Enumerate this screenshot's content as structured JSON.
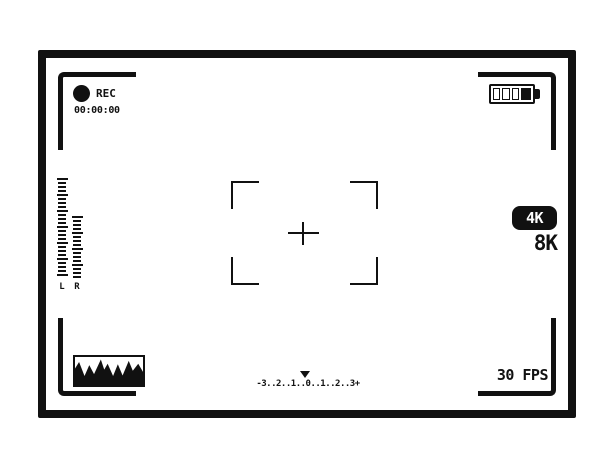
{
  "viewfinder": {
    "colors": {
      "ink": "#111111",
      "paper": "#ffffff"
    },
    "rec": {
      "label": "REC",
      "timecode": "00:00:00",
      "dot_icon": "filled-circle"
    },
    "battery": {
      "icon": "battery-horizontal",
      "cells": [
        "empty",
        "empty",
        "empty",
        "filled"
      ],
      "filled_side": "right"
    },
    "audio_meter": {
      "left_label": "L",
      "right_label": "R",
      "left_bars": 25,
      "right_bars": 16,
      "wide_every": 4
    },
    "focus": {
      "crosshair_icon": "plus-crosshair",
      "bracket_icon": "corner-bracket"
    },
    "resolution": {
      "active": "4K",
      "secondary": "8K"
    },
    "framerate": "30 FPS",
    "exposure_scale": {
      "text": "-3..2..1..0..1..2..3+",
      "marker_icon": "triangle-down",
      "marker_over": "0"
    },
    "histogram": {
      "icon": "waveform-mountains",
      "points": [
        [
          0,
          41
        ],
        [
          6,
          18
        ],
        [
          14,
          68
        ],
        [
          21,
          29
        ],
        [
          28,
          61
        ],
        [
          38,
          9
        ],
        [
          43,
          45
        ],
        [
          48,
          24
        ],
        [
          56,
          68
        ],
        [
          63,
          26
        ],
        [
          70,
          66
        ],
        [
          79,
          14
        ],
        [
          85,
          49
        ],
        [
          93,
          24
        ],
        [
          100,
          53
        ]
      ]
    }
  }
}
